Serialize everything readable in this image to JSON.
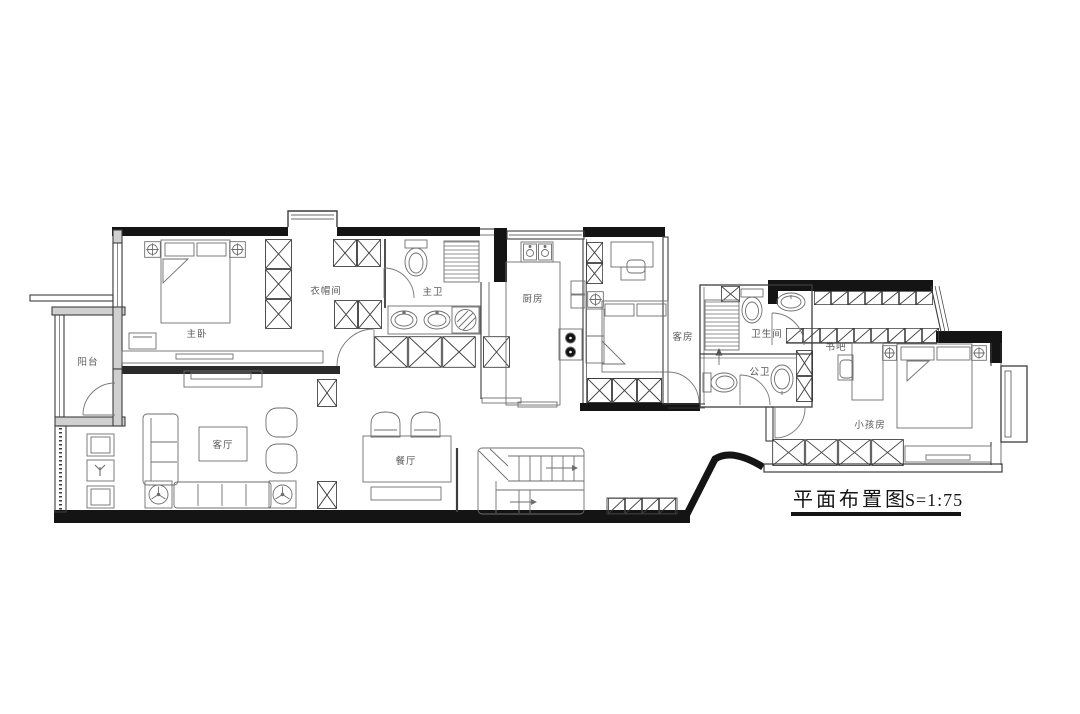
{
  "drawing": {
    "title": "平面布置图",
    "scale": "S=1:75"
  },
  "rooms": {
    "balcony": "阳台",
    "master_bedroom": "主卧",
    "cloakroom": "衣帽间",
    "master_bath": "主卫",
    "kitchen": "厨房",
    "guest_room": "客房",
    "bathroom": "卫生间",
    "public_bath": "公卫",
    "book_bar": "书吧",
    "kids_room": "小孩房",
    "living_room": "客厅",
    "dining_room": "餐厅"
  },
  "colors": {
    "wall": "#141414",
    "thin_wall": "#3d3d3d",
    "furniture_line": "#6e6e6e",
    "label": "#5a5a5a",
    "background": "#ffffff"
  }
}
